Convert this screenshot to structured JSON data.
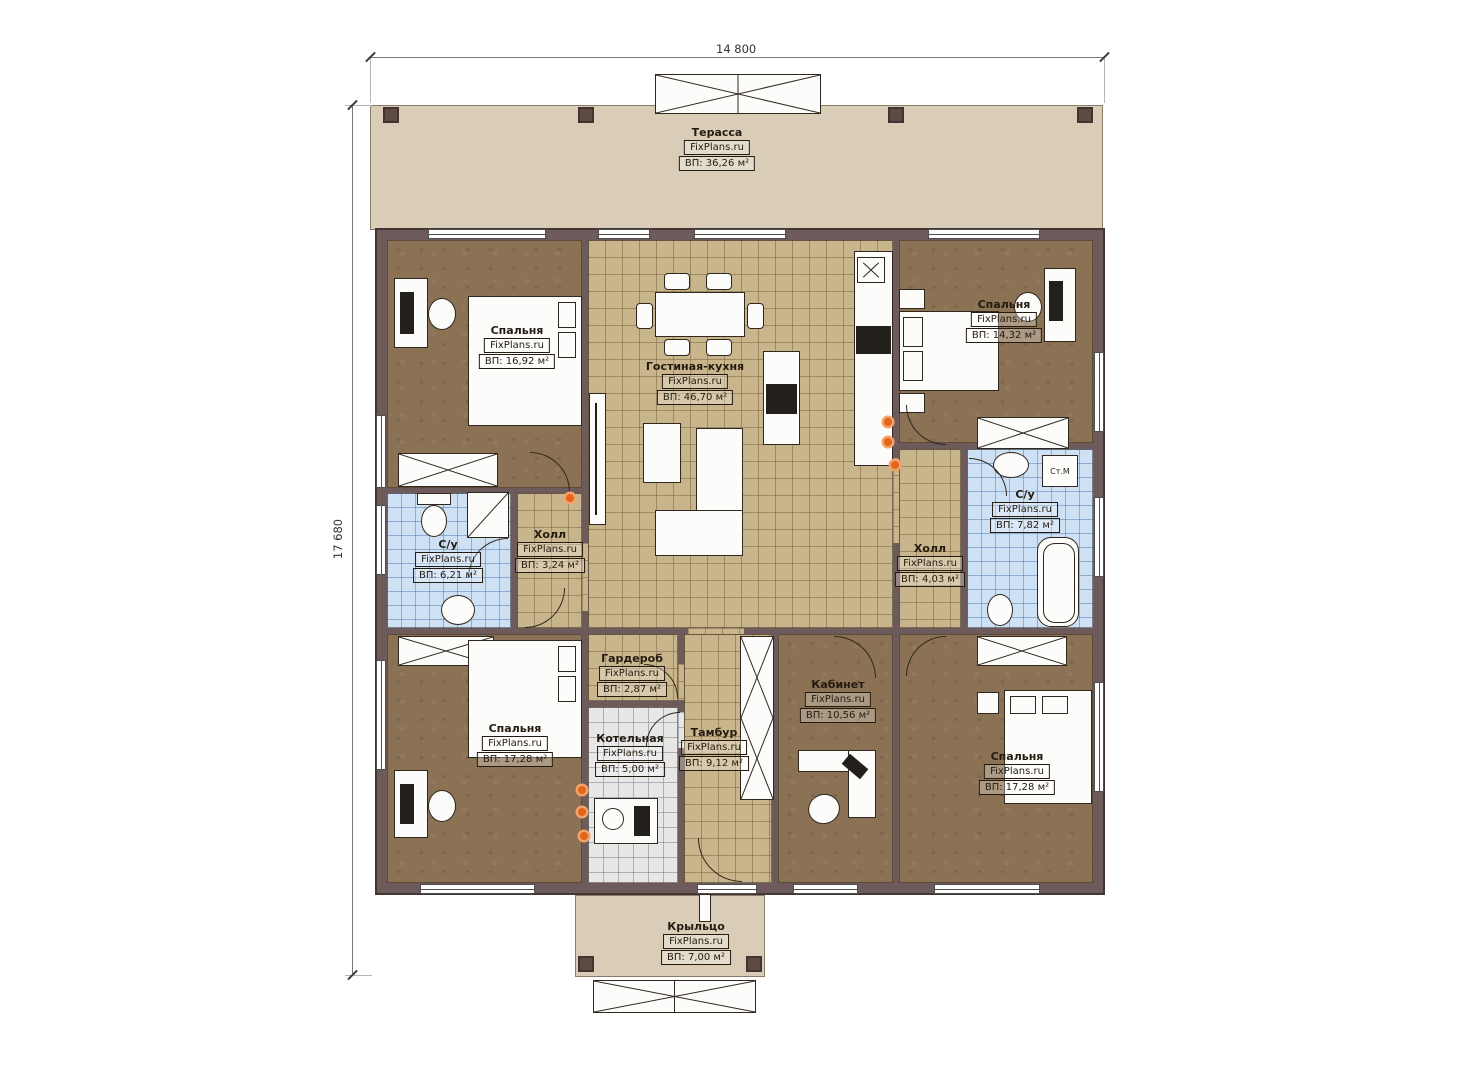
{
  "watermark": "FixPlans.ru",
  "dimensions": {
    "width_label": "14 800",
    "height_label": "17 680"
  },
  "labels": {
    "washing_machine": "Ст.М"
  },
  "rooms": [
    {
      "id": "terrace",
      "name": "Терасса",
      "area": "ВП: 36,26 м²"
    },
    {
      "id": "bedroom_tl",
      "name": "Спальня",
      "area": "ВП: 16,92 м²"
    },
    {
      "id": "living",
      "name": "Гостиная-кухня",
      "area": "ВП: 46,70 м²"
    },
    {
      "id": "bedroom_tr",
      "name": "Спальня",
      "area": "ВП: 14,32 м²"
    },
    {
      "id": "bath_left",
      "name": "С/у",
      "area": "ВП: 6,21 м²"
    },
    {
      "id": "hall_left",
      "name": "Холл",
      "area": "ВП: 3,24 м²"
    },
    {
      "id": "hall_right",
      "name": "Холл",
      "area": "ВП: 4,03 м²"
    },
    {
      "id": "bath_right",
      "name": "С/у",
      "area": "ВП: 7,82 м²"
    },
    {
      "id": "bedroom_bl",
      "name": "Спальня",
      "area": "ВП: 17,28 м²"
    },
    {
      "id": "wardrobe",
      "name": "Гардероб",
      "area": "ВП: 2,87 м²"
    },
    {
      "id": "boiler",
      "name": "Котельная",
      "area": "ВП: 5,00 м²"
    },
    {
      "id": "tambur",
      "name": "Тамбур",
      "area": "ВП: 9,12 м²"
    },
    {
      "id": "office",
      "name": "Кабинет",
      "area": "ВП: 10,56 м²"
    },
    {
      "id": "bedroom_br",
      "name": "Спальня",
      "area": "ВП: 17,28 м²"
    },
    {
      "id": "porch",
      "name": "Крыльцо",
      "area": "ВП: 7,00 м²"
    }
  ],
  "colors": {
    "wall": "#6d5a5a",
    "floor_wood": "#8b7254",
    "tile_tan": "#c9b58c",
    "tile_blue": "#cde0f4",
    "tile_gray": "#e7e7e7",
    "terrace": "#d9cdb8",
    "outlet": "#e2651b"
  }
}
